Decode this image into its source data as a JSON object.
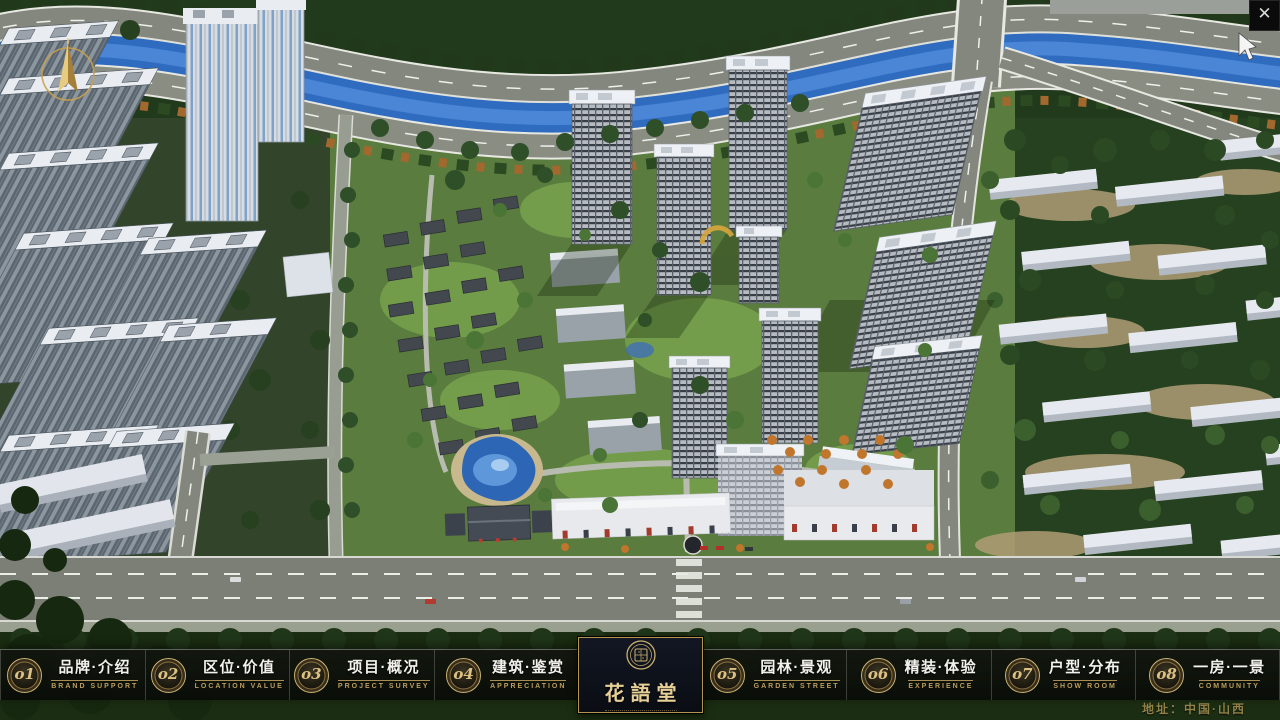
{
  "window": {
    "close_glyph": "✕"
  },
  "nav": {
    "items": [
      {
        "number": "o1",
        "title": "品牌·介绍",
        "subtitle": "BRAND SUPPORT"
      },
      {
        "number": "o2",
        "title": "区位·价值",
        "subtitle": "LOCATION VALUE"
      },
      {
        "number": "o3",
        "title": "项目·概况",
        "subtitle": "PROJECT SURVEY"
      },
      {
        "number": "o4",
        "title": "建筑·鉴赏",
        "subtitle": "APPRECIATION"
      },
      {
        "number": "o5",
        "title": "园林·景观",
        "subtitle": "GARDEN STREET"
      },
      {
        "number": "o6",
        "title": "精装·体验",
        "subtitle": "EXPERIENCE"
      },
      {
        "number": "o7",
        "title": "户型·分布",
        "subtitle": "SHOW ROOM"
      },
      {
        "number": "o8",
        "title": "一房·一景",
        "subtitle": "COMMUNITY"
      }
    ]
  },
  "logo": {
    "name": "花語堂"
  },
  "footer": {
    "address": "地址：中国·山西"
  },
  "colors": {
    "gold": "#c9a96a",
    "gold_dim": "#8f8147",
    "bar_bg": "rgba(12,14,11,0.85)",
    "panel_bg": "#0c1019",
    "title_text": "#f2f1ec",
    "river_blue": "#2f6cc0",
    "site_green": "#5a7c3e"
  }
}
